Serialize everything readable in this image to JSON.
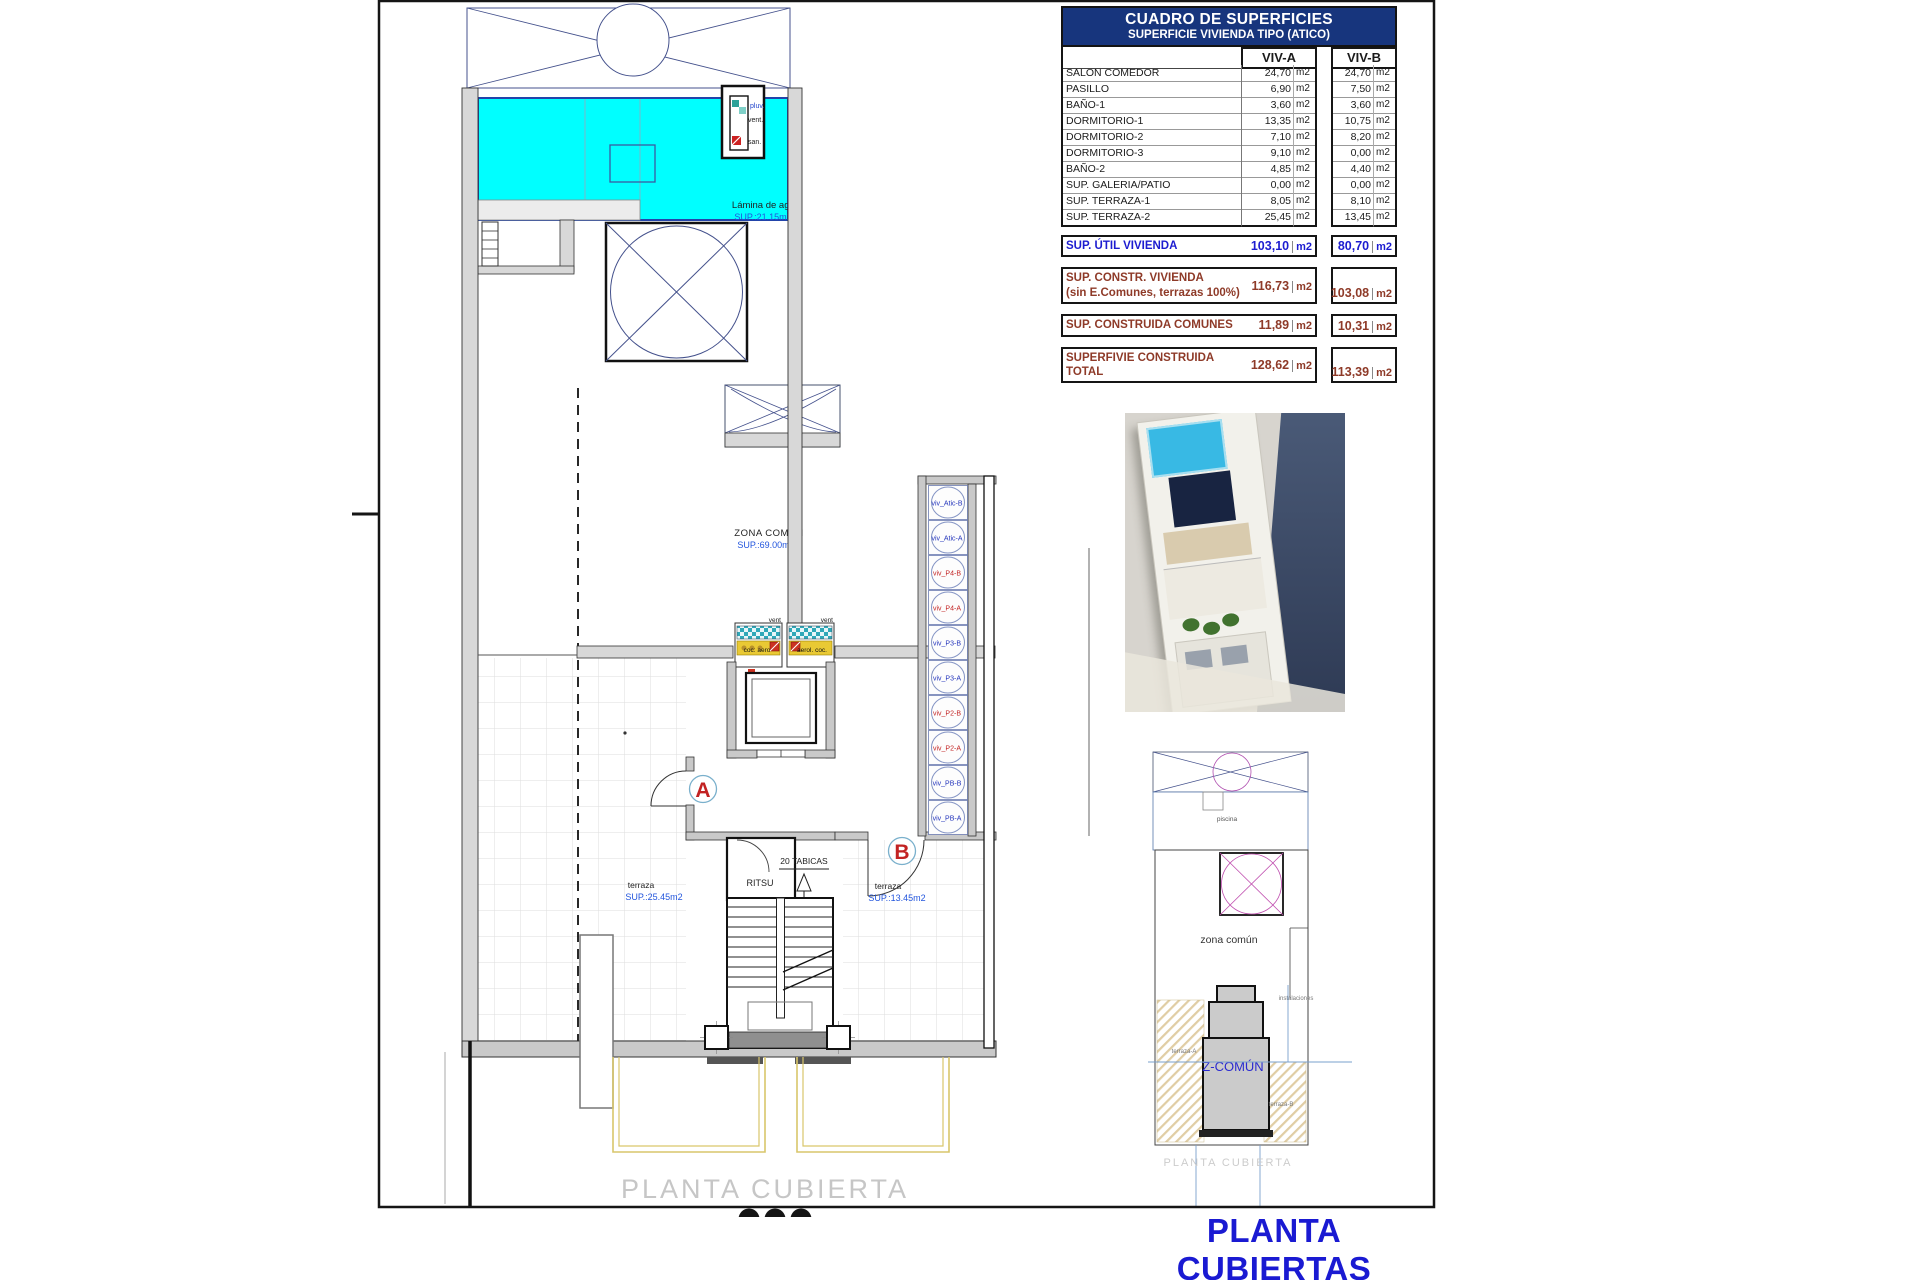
{
  "page": {
    "main_title": "PLANTA CUBIERTAS",
    "watermark": "PLANTA CUBIERTA"
  },
  "colors": {
    "accent_blue": "#1c1cd0",
    "maroon": "#8e3a28",
    "navy_header": "#17357d",
    "pool_cyan": "#00ffff",
    "label_blue": "#2255dd",
    "riser_blue": "#2233bb",
    "riser_red": "#c22222"
  },
  "surface_table": {
    "title": "CUADRO DE SUPERFICIES",
    "subtitle": "SUPERFICIE VIVIENDA TIPO  (ATICO)",
    "columns": [
      "VIV-A",
      "VIV-B"
    ],
    "unit": "m2",
    "rows": [
      {
        "label": "SALON COMEDOR",
        "a": "24,70",
        "b": "24,70"
      },
      {
        "label": "PASILLO",
        "a": "6,90",
        "b": "7,50"
      },
      {
        "label": "BAÑO-1",
        "a": "3,60",
        "b": "3,60"
      },
      {
        "label": "DORMITORIO-1",
        "a": "13,35",
        "b": "10,75"
      },
      {
        "label": "DORMITORIO-2",
        "a": "7,10",
        "b": "8,20"
      },
      {
        "label": "DORMITORIO-3",
        "a": "9,10",
        "b": "0,00"
      },
      {
        "label": "BAÑO-2",
        "a": "4,85",
        "b": "4,40"
      },
      {
        "label": "SUP. GALERIA/PATIO",
        "a": "0,00",
        "b": "0,00"
      },
      {
        "label": "SUP. TERRAZA-1",
        "a": "8,05",
        "b": "8,10"
      },
      {
        "label": "SUP. TERRAZA-2",
        "a": "25,45",
        "b": "13,45"
      }
    ],
    "summary": [
      {
        "lines": [
          "SUP. ÚTIL VIVIENDA"
        ],
        "a": "103,10",
        "b": "80,70",
        "color": "blue"
      },
      {
        "lines": [
          "SUP. CONSTR. VIVIENDA",
          "(sin E.Comunes, terrazas 100%)"
        ],
        "a": "116,73",
        "b": "103,08",
        "color": "maroon"
      },
      {
        "lines": [
          "SUP. CONSTRUIDA COMUNES"
        ],
        "a": "11,89",
        "b": "10,31",
        "color": "maroon"
      },
      {
        "lines": [
          "SUPERFIVIE CONSTRUIDA",
          "TOTAL"
        ],
        "a": "128,62",
        "b": "113,39",
        "color": "maroon"
      }
    ]
  },
  "plan": {
    "pool": {
      "label": "Lámina de agua",
      "sup": "SUP.:21.15m2"
    },
    "zona_comun": {
      "label": "ZONA COMÚN",
      "sup": "SUP.:69.00m2"
    },
    "terraza_a": {
      "label": "terraza",
      "sup": "SUP.:25.45m2"
    },
    "terraza_b": {
      "label": "terraza",
      "sup": "SUP.:13.45m2"
    },
    "ritsu": "RITSU",
    "tabicas": "20 TABICAS",
    "door_a": "A",
    "door_b": "B",
    "shaft": {
      "l1": "pluv.",
      "l2": "vent.",
      "l3": "san."
    },
    "panels": {
      "left_top": "vent",
      "left_bottom": "coc: aero",
      "right_top": "vent",
      "right_bottom": "aerol. coc.",
      "below": "san."
    },
    "risers": [
      {
        "label": "viv_Atic-B",
        "color": "blue"
      },
      {
        "label": "viv_Atic-A",
        "color": "blue"
      },
      {
        "label": "viv_P4-B",
        "color": "red"
      },
      {
        "label": "viv_P4-A",
        "color": "red"
      },
      {
        "label": "viv_P3-B",
        "color": "blue"
      },
      {
        "label": "viv_P3-A",
        "color": "blue"
      },
      {
        "label": "viv_P2-B",
        "color": "red"
      },
      {
        "label": "viv_P2-A",
        "color": "red"
      },
      {
        "label": "viv_PB-B",
        "color": "blue"
      },
      {
        "label": "viv_PB-A",
        "color": "blue"
      }
    ]
  },
  "mini_plan": {
    "piscina": "piscina",
    "zona": "zona común",
    "instalaciones": "instalaciones",
    "z_comun": "Z-COMÚN",
    "terraza_a": "terraza-A",
    "terraza_b": "terraza-B",
    "caption": "PLANTA CUBIERTA"
  }
}
